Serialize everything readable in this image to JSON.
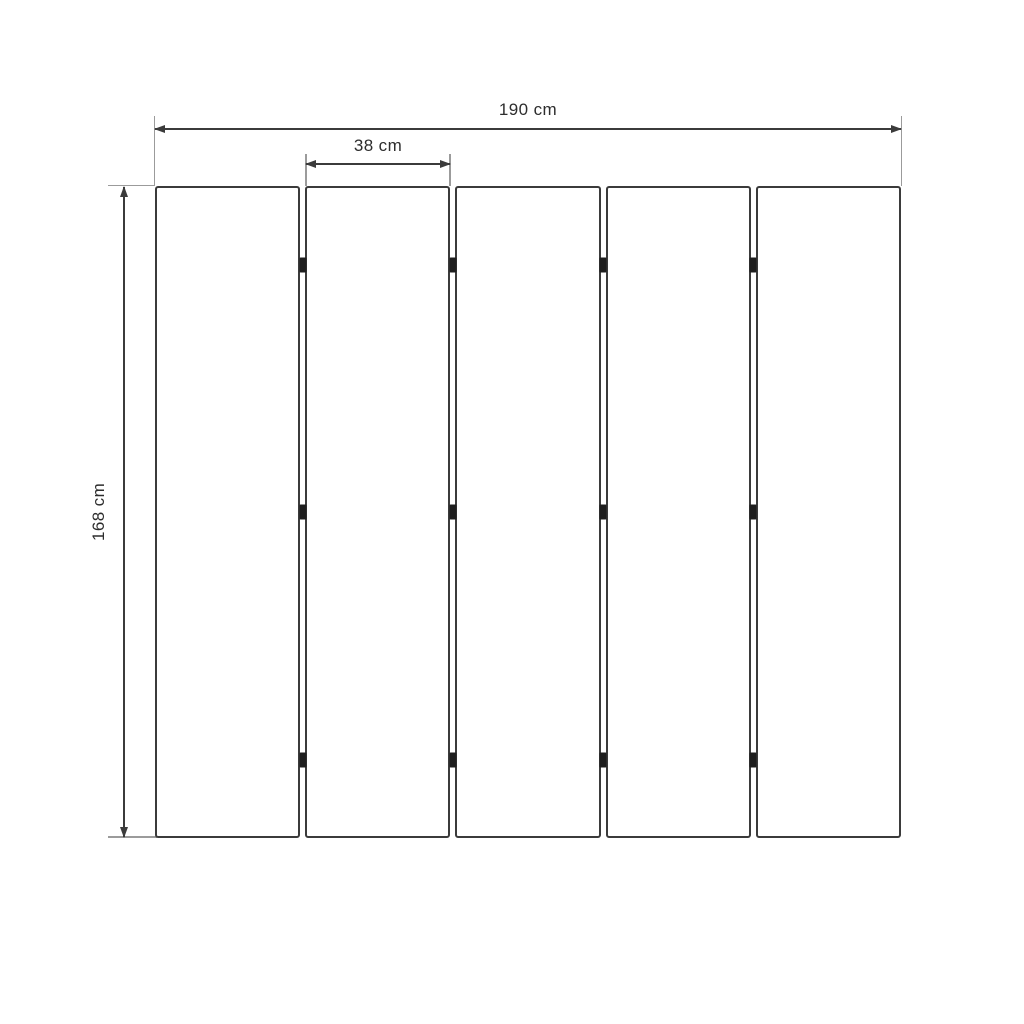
{
  "diagram": {
    "type": "technical-dimension-drawing",
    "panels": {
      "count": 5,
      "gaps": 4,
      "hinges_per_gap": 3
    },
    "dimensions": {
      "total_width": {
        "label": "190 cm",
        "orientation": "horizontal"
      },
      "panel_width": {
        "label": "38 cm",
        "orientation": "horizontal"
      },
      "height": {
        "label": "168 cm",
        "orientation": "vertical"
      }
    },
    "colors": {
      "background": "#ffffff",
      "panel_border": "#3b3b3b",
      "dimension_line": "#3b3b3b",
      "extension_line": "#9b9b9b",
      "hinge": "#1e1e1e",
      "text": "#2d2d2d"
    }
  }
}
